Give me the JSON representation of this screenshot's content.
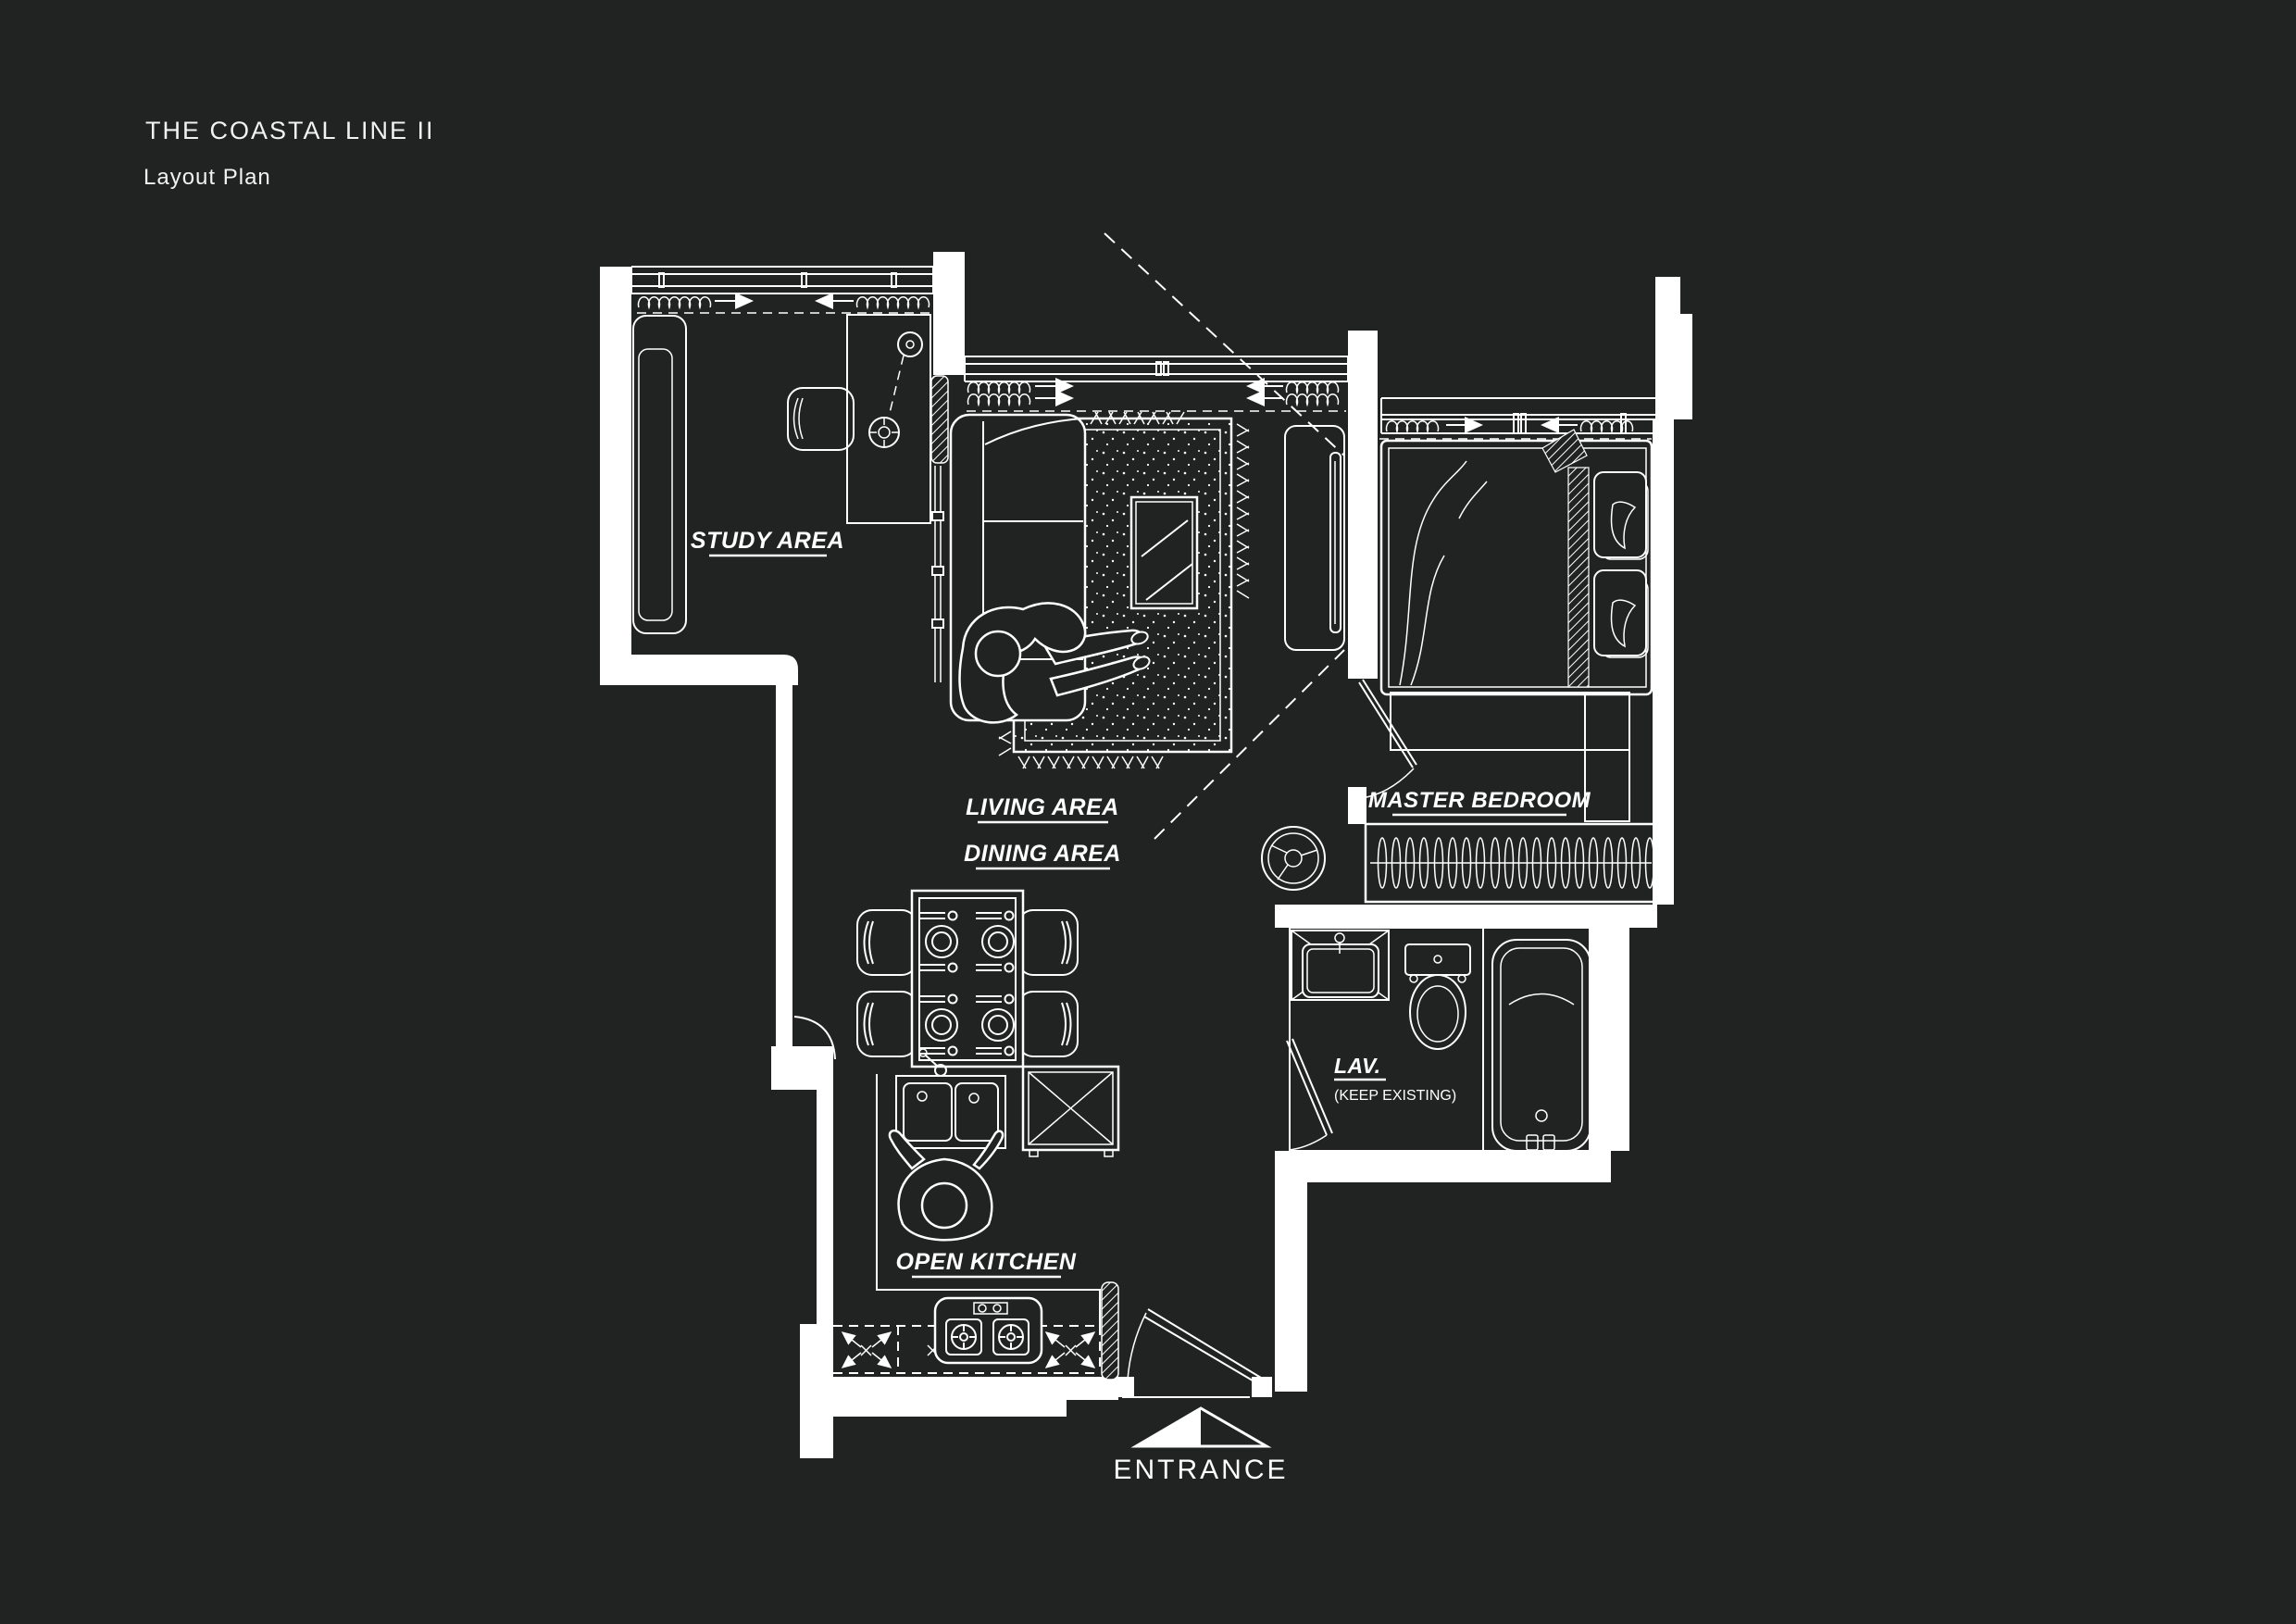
{
  "theme": {
    "background": "#212322",
    "line": "#ffffff",
    "text": "#f2f2f2"
  },
  "header": {
    "title": "THE COASTAL LINE II",
    "subtitle": "Layout Plan"
  },
  "plan": {
    "rooms": {
      "study": {
        "label": "STUDY AREA"
      },
      "living": {
        "label": "LIVING AREA"
      },
      "dining": {
        "label": "DINING AREA"
      },
      "master_bedroom": {
        "label": "MASTER BEDROOM"
      },
      "lavatory": {
        "label": "LAV.",
        "note": "(KEEP EXISTING)"
      },
      "kitchen": {
        "label": "OPEN KITCHEN"
      },
      "entrance": {
        "label": "ENTRANCE"
      }
    }
  }
}
